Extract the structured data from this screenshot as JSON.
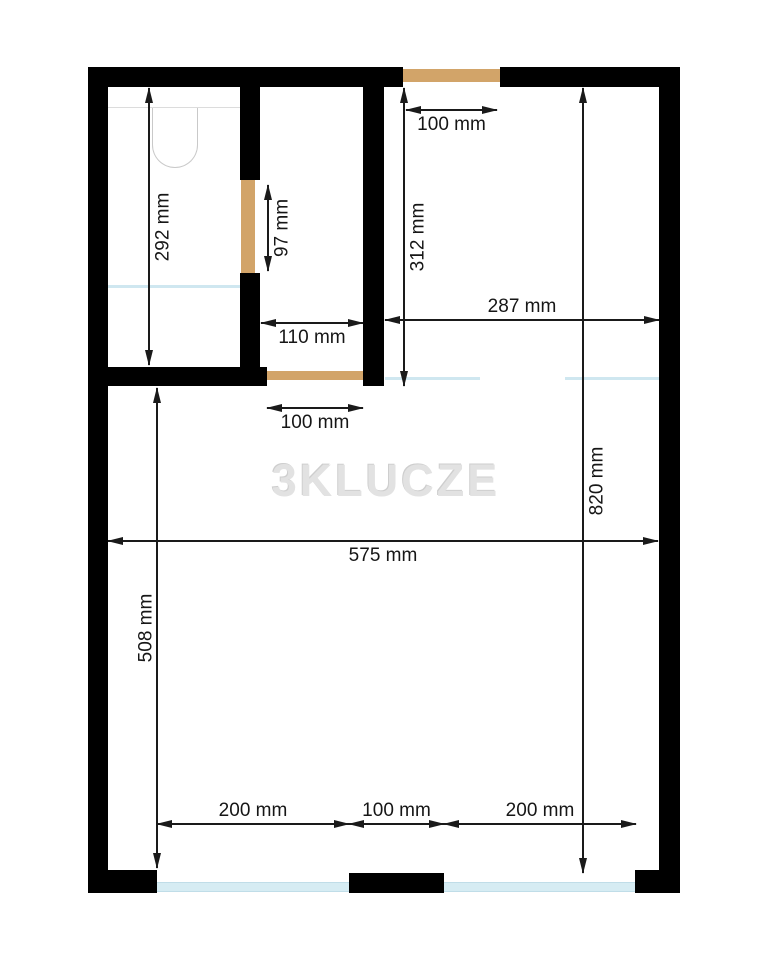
{
  "watermark": "3KLUCZE",
  "dims": {
    "top_door": "100 mm",
    "room_tr_height": "312 mm",
    "room_tr_width": "287 mm",
    "bathroom_height": "292 mm",
    "bathroom_door": "97 mm",
    "hallway_width": "110 mm",
    "hallway_door": "100 mm",
    "living_width": "575 mm",
    "inner_height": "820 mm",
    "living_height_left": "508 mm",
    "window_left": "200 mm",
    "window_pier": "100 mm",
    "window_right": "200 mm"
  },
  "colors": {
    "wall": "#000000",
    "door": "#d2a469",
    "window": "#d6ecf3",
    "dimension": "#1a1a1a",
    "watermark": "#e2e2e2"
  }
}
